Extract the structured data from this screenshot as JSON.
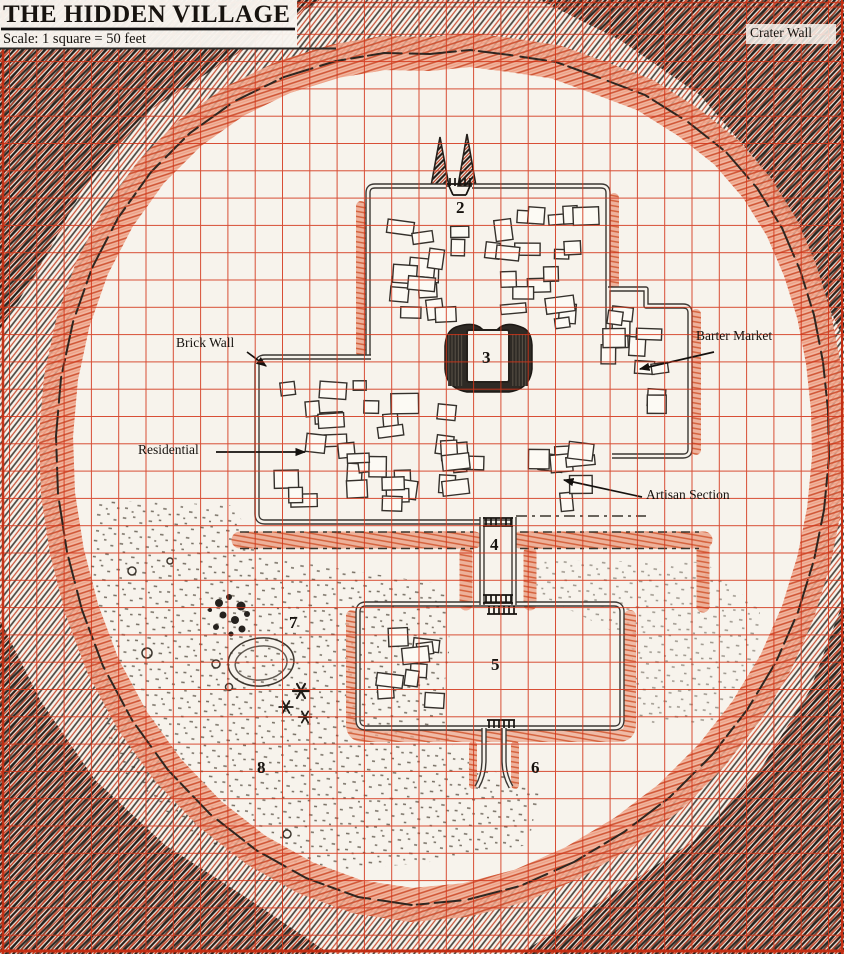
{
  "map": {
    "title": "THE HIDDEN VILLAGE",
    "scale_note": "Scale: 1 square = 50 feet",
    "grid": {
      "square_feet": 50,
      "grid_color": "#d23418"
    },
    "region_labels": {
      "crater_wall": "Crater Wall",
      "brick_wall": "Brick Wall",
      "residential": "Residential",
      "barter_market": "Barter Market",
      "artisan_section": "Artisan Section"
    },
    "numbered_markers": [
      {
        "num": "2"
      },
      {
        "num": "3"
      },
      {
        "num": "4"
      },
      {
        "num": "5"
      },
      {
        "num": "6"
      },
      {
        "num": "7"
      },
      {
        "num": "8"
      }
    ],
    "colors": {
      "paper": "#f7f3ec",
      "grid_red": "#d23418",
      "ink_black": "#241f1a",
      "rim_salmon": "#efa78f"
    }
  }
}
